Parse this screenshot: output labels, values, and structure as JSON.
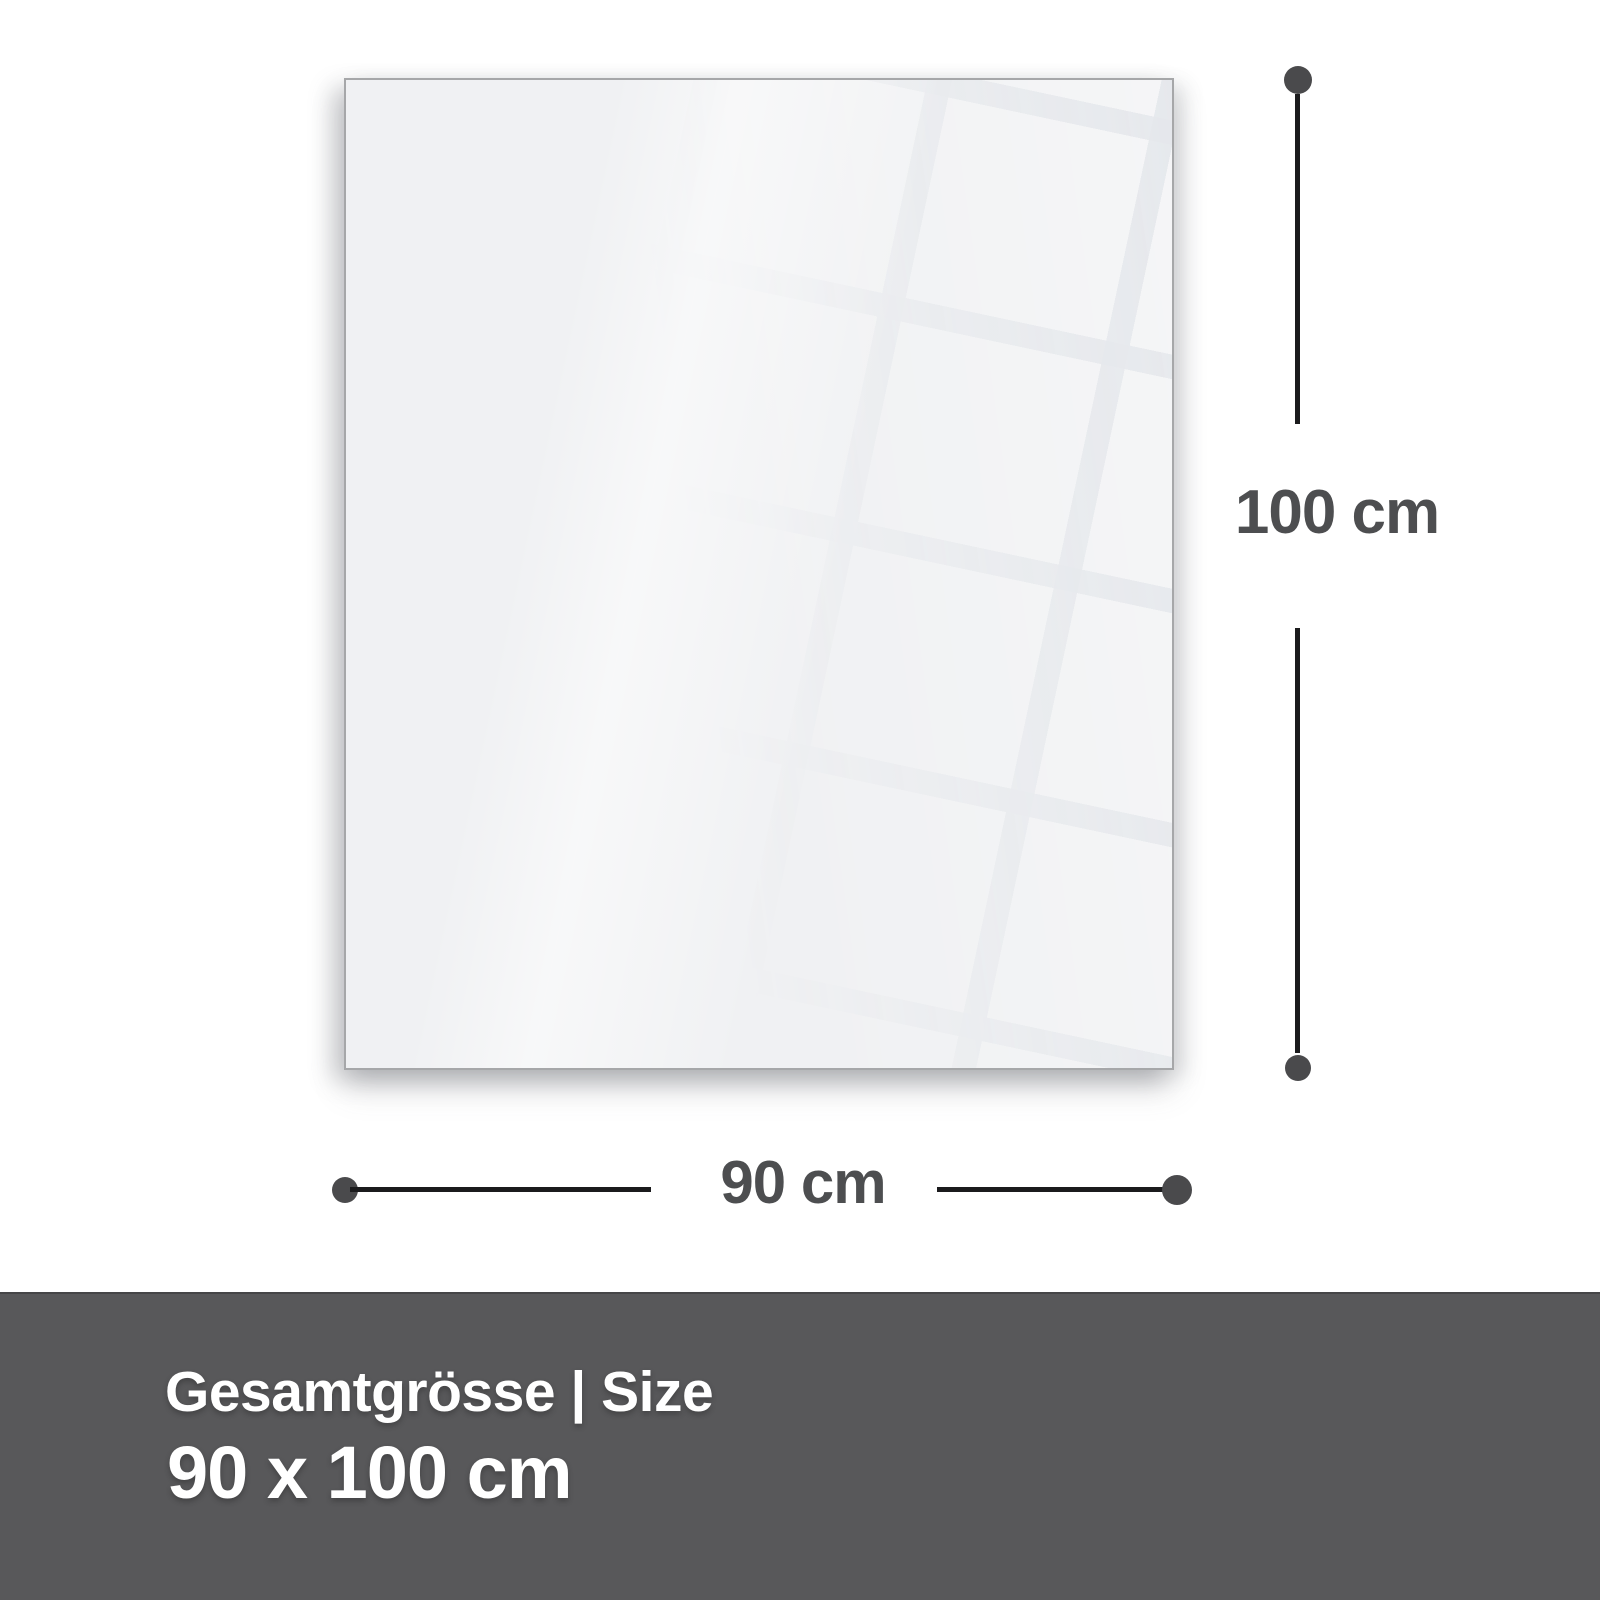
{
  "diagram": {
    "height_dimension": {
      "label": "100 cm"
    },
    "width_dimension": {
      "label": "90 cm"
    }
  },
  "footer": {
    "title": "Gesamtgrösse | Size",
    "size": "90 x 100 cm"
  },
  "colors": {
    "background": "#ffffff",
    "panel_fill": "#f0f1f3",
    "panel_border": "#a6a7a9",
    "reflection_tile": "#f7f8fa",
    "reflection_gap": "#e9ebee",
    "dimension_line": "#1b1b1d",
    "dimension_dot": "#4a4a4c",
    "dimension_label_text": "#4d4e50",
    "footer_background": "#58585a",
    "footer_text": "#ffffff"
  }
}
